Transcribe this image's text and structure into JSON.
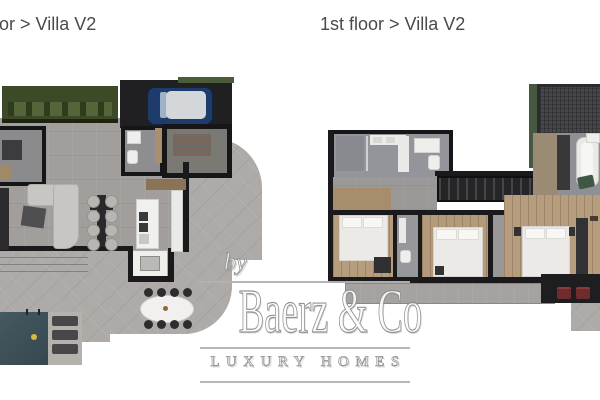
{
  "titles": {
    "left": "or > Villa V2",
    "right": "1st floor > Villa V2",
    "text_color": "#4a4a4a"
  },
  "watermark": {
    "prefix": "by",
    "brand": "Baerz & Co",
    "tagline": "LUXURY HOMES",
    "color": "#ffffff",
    "outline_color": "#8f8f8f"
  },
  "colors": {
    "background": "#ffffff",
    "wall": "#1a1a1c",
    "concrete_floor": "#a19e9b",
    "terrace": "#adaaa7",
    "wood_floor": "#b59d7e",
    "garden_green": "#3c4a27",
    "planter_green": "#566439",
    "pool_water": "#3f5157",
    "pool_ball_yellow": "#d8bb40",
    "car_body_blue": "#1e3c6b",
    "car_roof_grey": "#d4d7d9",
    "bed_white": "#eceae6",
    "roof_dark": "#47474b",
    "roof_green_edge": "#475841",
    "red_lounger": "#6e2c2c",
    "green_chair": "#3f5745"
  }
}
